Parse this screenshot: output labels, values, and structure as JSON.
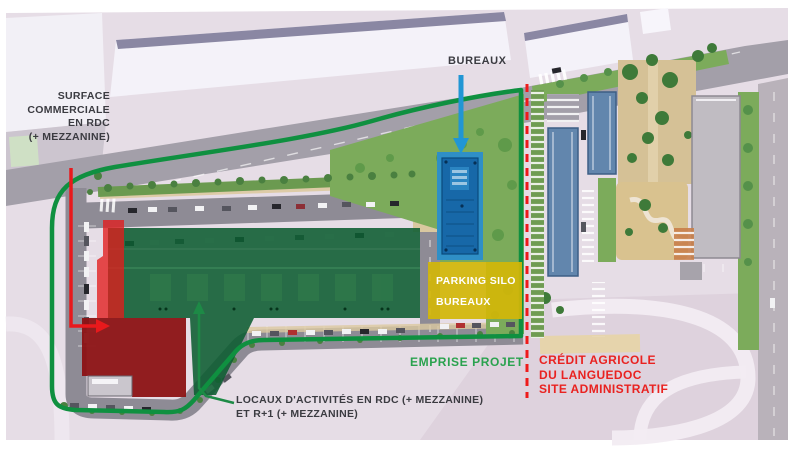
{
  "annotations": {
    "surface_commerciale": {
      "lines": [
        "SURFACE",
        "COMMERCIALE",
        "EN RDC",
        "(+ MEZZANINE)"
      ]
    },
    "bureaux": {
      "label": "BUREAUX"
    },
    "parking_silo": {
      "line1": "PARKING SILO",
      "line2": "BUREAUX"
    },
    "emprise_projet": {
      "label": "EMPRISE PROJET"
    },
    "credit_agricole": {
      "line1": "CRÉDIT AGRICOLE",
      "line2": "DU LANGUEDOC",
      "line3": "SITE ADMINISTRATIF"
    },
    "locaux_activites": {
      "line1": "LOCAUX D'ACTIVITÉS EN RDC (+ MEZZANINE)",
      "line2": "ET R+1 (+ MEZZANINE)"
    }
  },
  "legend_colors": {
    "emprise_projet_line": "#0f9040",
    "neighbor_limit_dashed": "#ee1b1b",
    "surface_commerciale_fill": "#c01f1f",
    "locaux_activites_fill": "#0d5c31",
    "bureaux_building_fill": "#1768a8",
    "parking_silo_fill": "#d3b608",
    "bureaux_arrow": "#2196d4"
  }
}
